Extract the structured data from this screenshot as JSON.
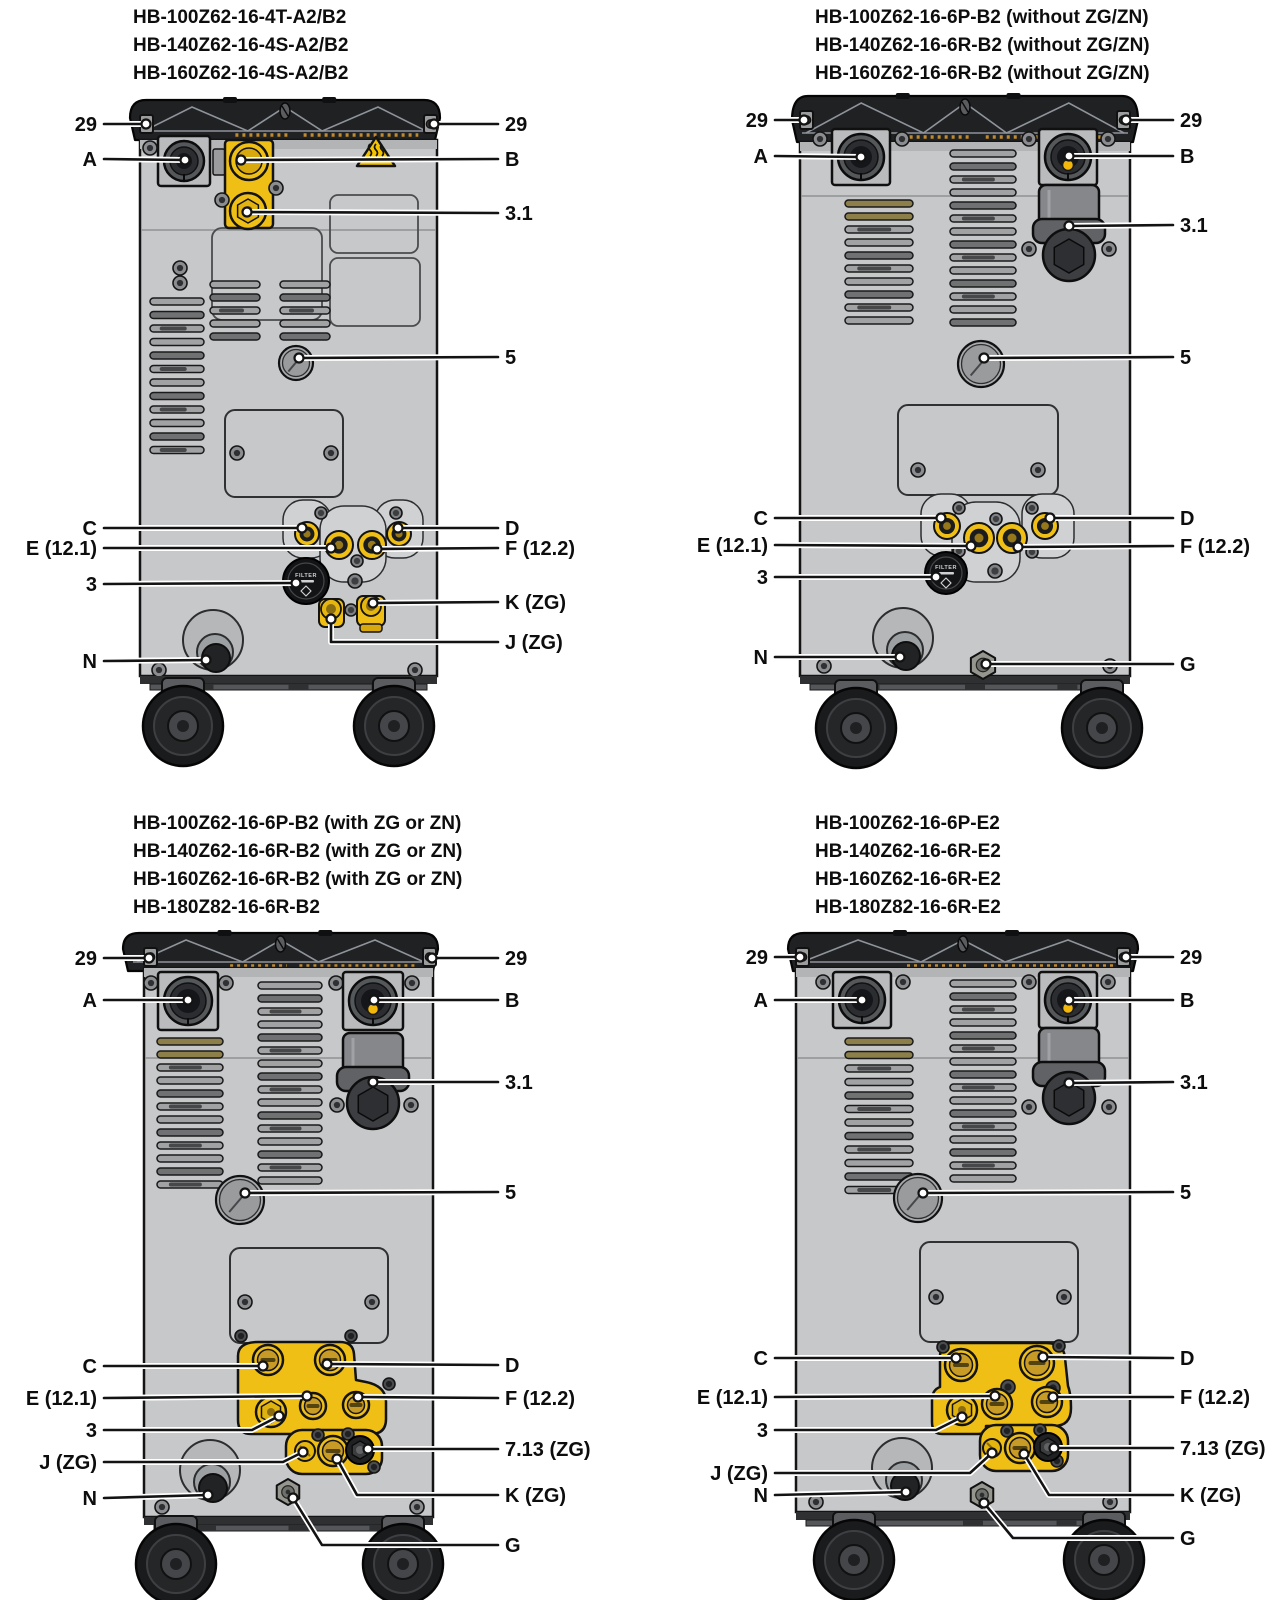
{
  "figure": {
    "kind": "technical-rear-view-connection-diagram",
    "units": 4,
    "filter_knob_text": "FILTER"
  },
  "colors": {
    "accent_yellow": "#f0bf15",
    "warning_yellow": "#f5c400",
    "body_gray": "#c7c8ca",
    "cap_black": "#1f2123",
    "leader_black": "#131313",
    "brass": "#c89b27"
  },
  "panels": [
    {
      "id": "p1",
      "title_lines": [
        "HB-100Z62-16-4T-A2/B2",
        "HB-140Z62-16-4S-A2/B2",
        "HB-160Z62-16-4S-A2/B2"
      ],
      "callouts": [
        {
          "id": "c29l",
          "label": "29"
        },
        {
          "id": "c29r",
          "label": "29"
        },
        {
          "id": "cA",
          "label": "A"
        },
        {
          "id": "cB",
          "label": "B"
        },
        {
          "id": "c31",
          "label": "3.1"
        },
        {
          "id": "c5",
          "label": "5"
        },
        {
          "id": "cC",
          "label": "C"
        },
        {
          "id": "cD",
          "label": "D"
        },
        {
          "id": "cE",
          "label": "E (12.1)"
        },
        {
          "id": "cF",
          "label": "F (12.2)"
        },
        {
          "id": "c3",
          "label": "3"
        },
        {
          "id": "cK",
          "label": "K (ZG)"
        },
        {
          "id": "cJ",
          "label": "J (ZG)"
        },
        {
          "id": "cN",
          "label": "N"
        }
      ]
    },
    {
      "id": "p2",
      "title_lines": [
        "HB-100Z62-16-6P-B2 (without ZG/ZN)",
        "HB-140Z62-16-6R-B2 (without ZG/ZN)",
        "HB-160Z62-16-6R-B2 (without ZG/ZN)"
      ],
      "callouts": [
        {
          "id": "c29l",
          "label": "29"
        },
        {
          "id": "c29r",
          "label": "29"
        },
        {
          "id": "cA",
          "label": "A"
        },
        {
          "id": "cB",
          "label": "B"
        },
        {
          "id": "c31",
          "label": "3.1"
        },
        {
          "id": "c5",
          "label": "5"
        },
        {
          "id": "cC",
          "label": "C"
        },
        {
          "id": "cD",
          "label": "D"
        },
        {
          "id": "cE",
          "label": "E (12.1)"
        },
        {
          "id": "cF",
          "label": "F (12.2)"
        },
        {
          "id": "c3",
          "label": "3"
        },
        {
          "id": "cN",
          "label": "N"
        },
        {
          "id": "cG",
          "label": "G"
        }
      ]
    },
    {
      "id": "p3",
      "title_lines": [
        "HB-100Z62-16-6P-B2 (with ZG or ZN)",
        "HB-140Z62-16-6R-B2 (with ZG or ZN)",
        "HB-160Z62-16-6R-B2 (with ZG or ZN)",
        "HB-180Z82-16-6R-B2"
      ],
      "callouts": [
        {
          "id": "c29l",
          "label": "29"
        },
        {
          "id": "c29r",
          "label": "29"
        },
        {
          "id": "cA",
          "label": "A"
        },
        {
          "id": "cB",
          "label": "B"
        },
        {
          "id": "c31",
          "label": "3.1"
        },
        {
          "id": "c5",
          "label": "5"
        },
        {
          "id": "cC",
          "label": "C"
        },
        {
          "id": "cD",
          "label": "D"
        },
        {
          "id": "cE",
          "label": "E (12.1)"
        },
        {
          "id": "cF",
          "label": "F (12.2)"
        },
        {
          "id": "c3",
          "label": "3"
        },
        {
          "id": "cJ",
          "label": "J (ZG)"
        },
        {
          "id": "cN",
          "label": "N"
        },
        {
          "id": "c713",
          "label": "7.13 (ZG)"
        },
        {
          "id": "cK",
          "label": "K (ZG)"
        },
        {
          "id": "cG",
          "label": "G"
        }
      ]
    },
    {
      "id": "p4",
      "title_lines": [
        "HB-100Z62-16-6P-E2",
        "HB-140Z62-16-6R-E2",
        "HB-160Z62-16-6R-E2",
        "HB-180Z82-16-6R-E2"
      ],
      "callouts": [
        {
          "id": "c29l",
          "label": "29"
        },
        {
          "id": "c29r",
          "label": "29"
        },
        {
          "id": "cA",
          "label": "A"
        },
        {
          "id": "cB",
          "label": "B"
        },
        {
          "id": "c31",
          "label": "3.1"
        },
        {
          "id": "c5",
          "label": "5"
        },
        {
          "id": "cC",
          "label": "C"
        },
        {
          "id": "cD",
          "label": "D"
        },
        {
          "id": "cE",
          "label": "E (12.1)"
        },
        {
          "id": "cF",
          "label": "F (12.2)"
        },
        {
          "id": "c3",
          "label": "3"
        },
        {
          "id": "cJ",
          "label": "J (ZG)"
        },
        {
          "id": "cN",
          "label": "N"
        },
        {
          "id": "c713",
          "label": "7.13 (ZG)"
        },
        {
          "id": "cK",
          "label": "K (ZG)"
        },
        {
          "id": "cG",
          "label": "G"
        }
      ]
    }
  ]
}
